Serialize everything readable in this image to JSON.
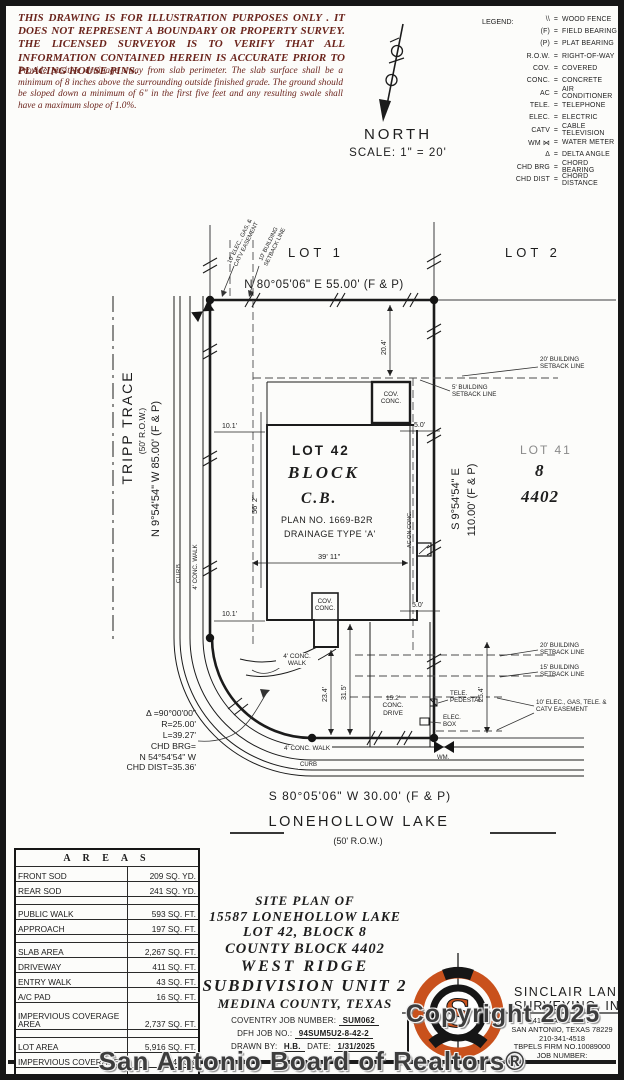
{
  "disclaimer": {
    "para1": "THIS DRAWING IS FOR ILLUSTRATION PURPOSES ONLY . IT DOES NOT REPRESENT A BOUNDARY OR PROPERTY SURVEY. THE LICENSED SURVEYOR IS TO VERIFY THAT ALL INFORMATION CONTAINED HEREIN IS ACCURATE PRIOR TO PLACING HOUSE PINS.",
    "para2": "Provide positive drainage away from slab perimeter. The slab surface shall be a minimum of 8 inches above the surrounding outside finished grade. The ground should be sloped down a minimum of 6\" in the first five feet and any resulting swale shall have a maximum slope of 1.0%."
  },
  "compass": {
    "north": "NORTH",
    "scale": "SCALE: 1\" = 20'"
  },
  "legend": {
    "title": "LEGEND:",
    "items": [
      {
        "symbol": "\\\\",
        "meaning": "WOOD FENCE"
      },
      {
        "symbol": "(F)",
        "meaning": "FIELD BEARING"
      },
      {
        "symbol": "(P)",
        "meaning": "PLAT BEARING"
      },
      {
        "symbol": "R.O.W.",
        "meaning": "RIGHT-OF-WAY"
      },
      {
        "symbol": "COV.",
        "meaning": "COVERED"
      },
      {
        "symbol": "CONC.",
        "meaning": "CONCRETE"
      },
      {
        "symbol": "AC",
        "meaning": "AIR CONDITIONER"
      },
      {
        "symbol": "TELE.",
        "meaning": "TELEPHONE"
      },
      {
        "symbol": "ELEC.",
        "meaning": "ELECTRIC"
      },
      {
        "symbol": "CATV",
        "meaning": "CABLE TELEVISION"
      },
      {
        "symbol": "WM ⋈",
        "meaning": "WATER METER"
      },
      {
        "symbol": "Δ",
        "meaning": "DELTA ANGLE"
      },
      {
        "symbol": "CHD BRG",
        "meaning": "CHORD BEARING"
      },
      {
        "symbol": "CHD DIST",
        "meaning": "CHORD DISTANCE"
      }
    ]
  },
  "plat": {
    "lot1": "LOT 1",
    "lot2": "LOT 2",
    "bearing_top": "N 80°05'06\" E  55.00'  (F & P)",
    "easement_top": "10' ELEC., GAS, & CATV EASEMENT",
    "setback_top": "10' BUILDING SETBACK LINE",
    "street_west_name": "TRIPP TRACE",
    "street_west_row": "(50' R.O.W.)",
    "bearing_west": "N 9°54'54\" W  85.00'  (F & P)",
    "curb": "CURB",
    "walk4": "4' CONC. WALK",
    "lot42": "LOT 42",
    "block": "BLOCK",
    "cb": "C.B.",
    "plan_no": "PLAN NO. 1669-B2R",
    "drainage": "DRAINAGE TYPE 'A'",
    "bearing_east_1": "S 9°54'54\" E",
    "bearing_east_2": "110.00' (F & P)",
    "lot41": "LOT 41",
    "lot41_block": "8",
    "lot41_cb": "4402",
    "setback20": "20' BUILDING SETBACK LINE",
    "setback5": "5' BUILDING SETBACK LINE",
    "setback15": "15' BUILDING SETBACK LINE",
    "cov_conc": "COV. CONC.",
    "ac_on_conc": "AC ON CONC.",
    "d20_4": "20.4'",
    "d10_1": "10.1'",
    "d56_2": "56' 2\"",
    "d39_11": "39' 11\"",
    "d5_0": "5.0'",
    "d23_4": "23.4'",
    "d31_5": "31.5'",
    "d25_4": "25.4'",
    "easement_bottom": "10' ELEC., GAS, TELE. & CATV EASEMENT",
    "tele_pedestal": "TELE. PEDESTAL",
    "elec_box": "ELEC. BOX",
    "wm": "WM.",
    "conc_drive": "15.2' CONC. DRIVE",
    "curve": [
      "Δ =90°00'00\"",
      "R=25.00'",
      "L=39.27'",
      "CHD BRG=",
      "N 54°54'54\" W",
      "CHD DIST=35.36'"
    ],
    "bearing_south": "S 80°05'06\" W  30.00'  (F & P)",
    "street_south": "LONEHOLLOW LAKE",
    "street_south_row": "(50' R.O.W.)"
  },
  "areas": {
    "title": "A R E A S",
    "rows": [
      {
        "l": "FRONT SOD",
        "v": "209 SQ. YD."
      },
      {
        "l": "REAR SOD",
        "v": "241 SQ. YD."
      },
      {
        "l": "",
        "v": ""
      },
      {
        "l": "PUBLIC WALK",
        "v": "593 SQ. FT."
      },
      {
        "l": "APPROACH",
        "v": "197 SQ. FT."
      },
      {
        "l": "",
        "v": ""
      },
      {
        "l": "SLAB AREA",
        "v": "2,267 SQ. FT."
      },
      {
        "l": "DRIVEWAY",
        "v": "411 SQ. FT."
      },
      {
        "l": "ENTRY WALK",
        "v": "43 SQ. FT."
      },
      {
        "l": "A/C PAD",
        "v": "16 SQ. FT."
      },
      {
        "l": "IMPERVIOUS COVERAGE AREA",
        "v": "2,737 SQ. FT."
      },
      {
        "l": "",
        "v": ""
      },
      {
        "l": "LOT AREA",
        "v": "5,916 SQ. FT."
      },
      {
        "l": "IMPERVIOUS COVERAGE",
        "v": "46.3%"
      },
      {
        "l": "",
        "v": ""
      }
    ]
  },
  "title_block": {
    "lines": [
      "SITE PLAN OF",
      "15587 LONEHOLLOW LAKE",
      "LOT 42, BLOCK 8",
      "COUNTY BLOCK 4402",
      "WEST RIDGE",
      "SUBDIVISION UNIT 2",
      "MEDINA COUNTY, TEXAS"
    ],
    "coventry_label": "COVENTRY JOB NUMBER:",
    "coventry_value": "SUM062",
    "dfh_label": "DFH JOB NO.:",
    "dfh_value": "94SUM5U2-8-42-2",
    "drawn_label": "DRAWN BY:",
    "drawn_value": "H.B.",
    "date_label": "DATE:",
    "date_value": "1/31/2025"
  },
  "surveyor": {
    "logo_s": "S",
    "name1": "SINCLAIR LAND",
    "name2": "SURVEYING, INC.",
    "addr1": "3411 MAGIC DRIVE",
    "addr2": "SAN ANTONIO, TEXAS 78229",
    "phone": "210-341-4518",
    "firm": "TBPELS FIRM NO.10089000",
    "job_label": "JOB NUMBER:"
  },
  "watermark": {
    "line1": "Copyright 2025",
    "line2": "San Antonio Board of Realtors®"
  },
  "colors": {
    "accent_orange": "#c9511c",
    "ink": "#1b1b1b",
    "disclaimer_red": "#6b241c"
  }
}
